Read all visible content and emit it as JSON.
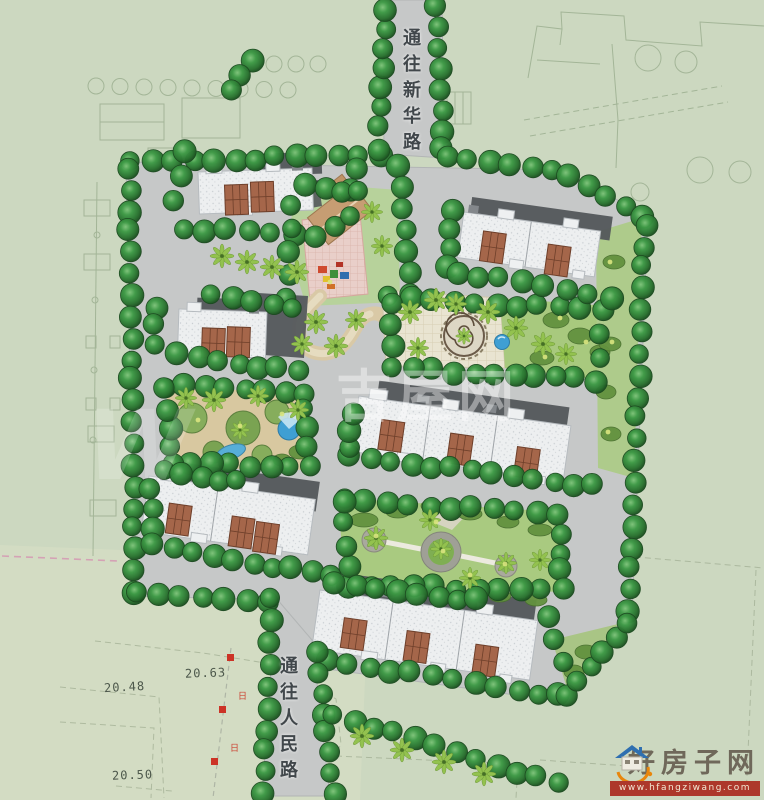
{
  "map": {
    "road_label_top": "通往新华路",
    "road_label_bottom": "通往人民路",
    "elevation_marks": [
      "20.63",
      "20.48",
      "20.50"
    ],
    "pole_mark_glyph": "日"
  },
  "watermark": {
    "text": "吉屋网",
    "ghost_letter": "W"
  },
  "logo": {
    "name": "好房子网",
    "url_text": "www.hfangziwang.com"
  },
  "colors": {
    "background": "#ccd8c0",
    "road": "#c6c8c8",
    "tree_dark": "#2e7d32",
    "palm_light": "#93c24f",
    "building_roof": "#edeff0",
    "building_bay": "#a5664a",
    "building_shadow": "#54585c",
    "water": "#45a5d6",
    "lawn": "#aecb8b",
    "sand": "#d8c8a0",
    "plaza_pink": "#e9cfc9",
    "logo_red": "#ad382b"
  }
}
